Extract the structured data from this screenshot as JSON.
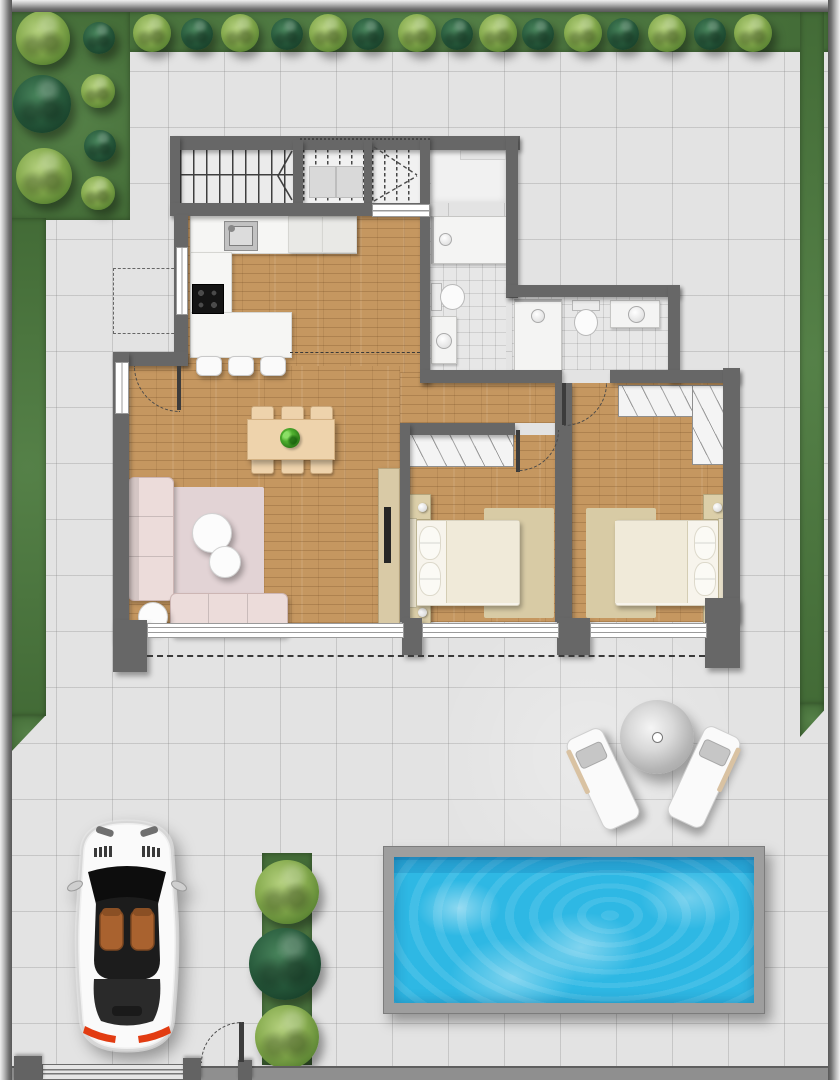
{
  "meta": {
    "title": "Top-view residential floor plan: two-bedroom house with kitchen, living-dining room, two bathrooms, staircase, driveway with car, garden hedges, sun deck with loungers and parasol, and swimming pool"
  },
  "colors": {
    "paving": "#e3e3e3",
    "paving_line": "rgba(125,125,125,0.28)",
    "garden": "#4c7a3e",
    "tree_light": "#86ab4e",
    "tree_light_hi": "#b3cf7d",
    "tree_dark": "#27593b",
    "tree_dark_hi": "#47825a",
    "wall": "#676767",
    "wood": "#c59760",
    "wood_line": "rgba(90,55,20,0.22)",
    "tile": "#e7e7e7",
    "counter": "#f6f6f4",
    "wardrobe": "#f4f4f4",
    "sofa": "#ecdcda",
    "rug_pink": "#e2d3d5",
    "rug_beige": "#d8cba5",
    "duvet": "#f0ead9",
    "duvet_w": "#f7f4ec",
    "table_wood": "#eed3ac",
    "nightstand": "#dccfa9",
    "tv_board": "#d9caa6",
    "water": "#2eb8e4",
    "pool_frame": "#9e9e9e",
    "lounger": "#fafafa",
    "seat_brown": "#a9622f",
    "taillight": "#e23c12",
    "car_body": "#fafafa"
  },
  "scene": {
    "type": "floor-plan",
    "indoor_areas": [
      "staircase",
      "entry-room",
      "kitchen",
      "living-dining-room",
      "hallway",
      "bathroom-1",
      "bathroom-2",
      "bedroom-1",
      "bedroom-2"
    ],
    "outdoor_areas": [
      "perimeter-garden",
      "paved-yard",
      "driveway",
      "sun-deck",
      "swimming-pool",
      "hedge-planter"
    ]
  },
  "garden": {
    "trees": [
      {
        "x": 43,
        "y": 38,
        "r": 27,
        "v": "light"
      },
      {
        "x": 42,
        "y": 104,
        "r": 29,
        "v": "dark"
      },
      {
        "x": 44,
        "y": 176,
        "r": 28,
        "v": "light"
      },
      {
        "x": 99,
        "y": 38,
        "r": 16,
        "v": "dark"
      },
      {
        "x": 98,
        "y": 91,
        "r": 17,
        "v": "light"
      },
      {
        "x": 100,
        "y": 146,
        "r": 16,
        "v": "dark"
      },
      {
        "x": 98,
        "y": 193,
        "r": 17,
        "v": "light"
      },
      {
        "x": 152,
        "y": 33,
        "r": 19,
        "v": "light"
      },
      {
        "x": 197,
        "y": 34,
        "r": 16,
        "v": "dark"
      },
      {
        "x": 240,
        "y": 33,
        "r": 19,
        "v": "light"
      },
      {
        "x": 287,
        "y": 34,
        "r": 16,
        "v": "dark"
      },
      {
        "x": 328,
        "y": 33,
        "r": 19,
        "v": "light"
      },
      {
        "x": 368,
        "y": 34,
        "r": 16,
        "v": "dark"
      },
      {
        "x": 417,
        "y": 33,
        "r": 19,
        "v": "light"
      },
      {
        "x": 457,
        "y": 34,
        "r": 16,
        "v": "dark"
      },
      {
        "x": 498,
        "y": 33,
        "r": 19,
        "v": "light"
      },
      {
        "x": 538,
        "y": 34,
        "r": 16,
        "v": "dark"
      },
      {
        "x": 583,
        "y": 33,
        "r": 19,
        "v": "light"
      },
      {
        "x": 623,
        "y": 34,
        "r": 16,
        "v": "dark"
      },
      {
        "x": 667,
        "y": 33,
        "r": 19,
        "v": "light"
      },
      {
        "x": 710,
        "y": 34,
        "r": 16,
        "v": "dark"
      },
      {
        "x": 753,
        "y": 33,
        "r": 19,
        "v": "light"
      },
      {
        "x": 287,
        "y": 892,
        "r": 32,
        "v": "light"
      },
      {
        "x": 285,
        "y": 964,
        "r": 36,
        "v": "dark"
      },
      {
        "x": 287,
        "y": 1037,
        "r": 32,
        "v": "light"
      }
    ]
  }
}
